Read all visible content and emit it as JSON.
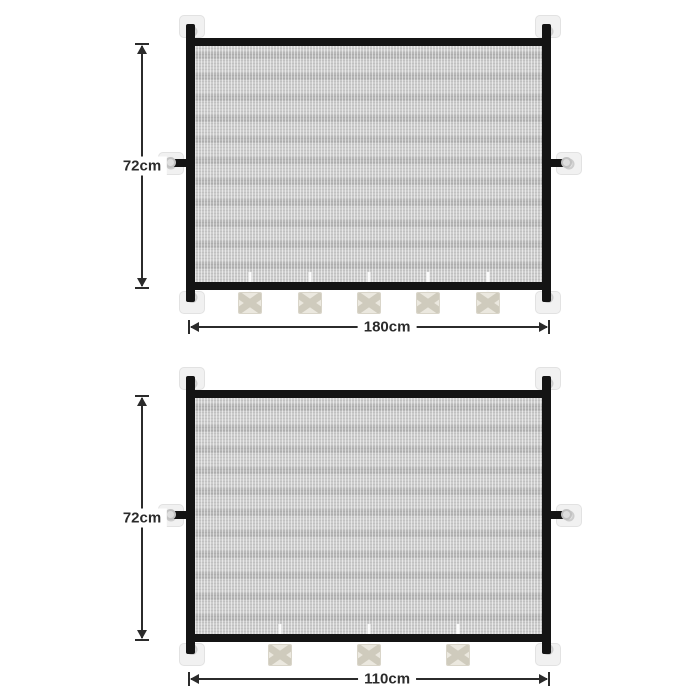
{
  "product_diagram": {
    "description_labels": {
      "height_unit_note": "cm"
    },
    "gates": [
      {
        "id": "mesh-gate-180",
        "height_label": "72cm",
        "width_label": "180cm",
        "buckle_count": 5
      },
      {
        "id": "mesh-gate-110",
        "height_label": "72cm",
        "width_label": "110cm",
        "buckle_count": 3
      }
    ],
    "colors": {
      "background": "#ffffff",
      "frame": "#141414",
      "mesh": "#c9c9c9",
      "pad": "#f1f1f1",
      "buckle": "#ebe8df",
      "buckle_x": "#cfcbbd",
      "dimension": "#2b2b2b"
    }
  }
}
